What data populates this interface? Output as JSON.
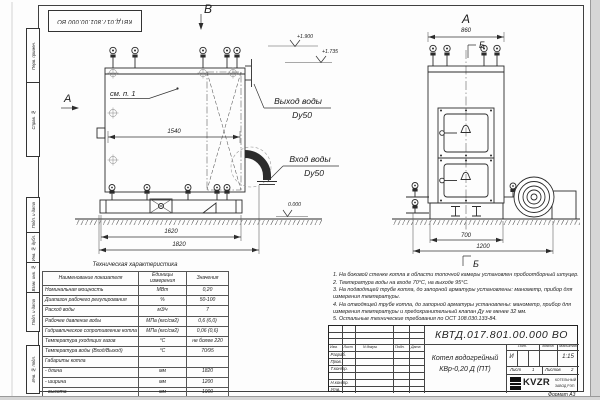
{
  "frame": {
    "stamp_top": "КВТД.017.801.00.000 ВО",
    "format_note": "Формат А3",
    "side_labels": [
      "Перв. примен.",
      "Справ. №",
      "Подп. и дата",
      "Инв. № дубл.",
      "Взам. инв. №",
      "Подп. и дата",
      "Инв. № подл."
    ]
  },
  "drawing": {
    "view_left": {
      "view_label": "В",
      "arrow_label": "А",
      "callout": "см. п. 1",
      "dim_width_inner": "1540",
      "dim_base": "1620",
      "dim_overall": "1820",
      "outlet_label": "Выход воды",
      "outlet_dn": "Dy50",
      "inlet_label": "Вход воды",
      "inlet_dn": "Dy50",
      "elev_top": "+1.900",
      "elev_mid": "+1.735",
      "elev_zero": "0.000"
    },
    "view_right": {
      "view_label": "А",
      "dim_top": "860",
      "section_label_top": "Б",
      "section_label_bottom": "Б",
      "dim_foundation": "700",
      "dim_base": "1200"
    }
  },
  "spec_table": {
    "title": "Техническая характеристика",
    "headers": [
      "Наименование показателя",
      "Единицы измерения",
      "Значения"
    ],
    "rows": [
      [
        "Номинальная мощность",
        "МВт",
        "0,20"
      ],
      [
        "Диапазон рабочего регулирования",
        "%",
        "50-100"
      ],
      [
        "Расход воды",
        "м3/ч",
        "7"
      ],
      [
        "Рабочее давление воды",
        "МПа (кгс/см2)",
        "0,6 (6,0)"
      ],
      [
        "Гидравлическое сопротивление котла",
        "МПа (кгс/см2)",
        "0,06 (0,6)"
      ],
      [
        "Температура уходящих газов",
        "°С",
        "не более 220"
      ],
      [
        "Температура воды (Вход/Выход)",
        "°С",
        "70/95"
      ],
      [
        "Габариты котла",
        "",
        ""
      ],
      [
        "   - длина",
        "мм",
        "1820"
      ],
      [
        "   - ширина",
        "мм",
        "1200"
      ],
      [
        "   - высота",
        "мм",
        "1900"
      ]
    ]
  },
  "notes": [
    "1. На боковой стенке котла в области топочной камеры установлен пробоотборный штуцер.",
    "2. Температура воды на входе 70°С, на выходе 95°С.",
    "3. На подводящей трубе котла, до запорной арматуры установлены: манометр, прибор для измерения температуры.",
    "4. На отводящей трубе котла, до запорной арматуры установлены: манометр, прибор для измерения температуры и предохранительный клапан Ду не менее 32 мм.",
    "5. Остальные технические требования по ОСТ 108.030.133-84."
  ],
  "title_block": {
    "doc_number": "КВТД.017.801.00.000 ВО",
    "product_line1": "Котел водогрейный",
    "product_line2": "КВр-0,20 Д  (ПТ)",
    "col_headers": [
      "Изм.",
      "Лист",
      "N докум.",
      "Подп.",
      "Дата"
    ],
    "row_labels": [
      "Разраб.",
      "Пров.",
      "Т.контр.",
      "",
      "Н.контр.",
      "Утв."
    ],
    "lit_header": "Лит.",
    "mass_header": "Масса",
    "scale_header": "Масштаб",
    "lit_value": "И",
    "scale_value": "1:15",
    "sheet_label": "Лист",
    "sheet_value": "1",
    "sheets_label": "Листов",
    "sheets_value": "2",
    "logo_text": "KVZR",
    "company_line1": "КОТЕЛЬНЫЙ",
    "company_line2": "ЗАВОД РЭП"
  }
}
